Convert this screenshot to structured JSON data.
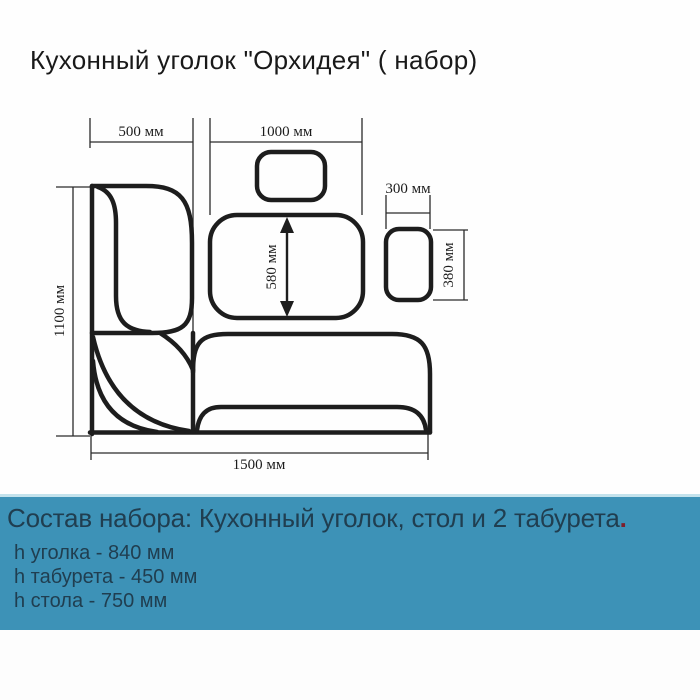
{
  "title": "Кухонный  уголок \"Орхидея\" ( набор)",
  "diagram": {
    "labels": {
      "corner_back_width": "500 мм",
      "bench_width": "1000 мм",
      "stool_width": "300 мм",
      "table_depth": "580 мм",
      "stool_depth": "380 мм",
      "corner_height": "1100 мм",
      "bench_length": "1500 мм"
    }
  },
  "banner": {
    "heading": "Состав набора: Кухонный уголок, стол и 2 табурета",
    "heading_period": ".",
    "specs": [
      "h уголка - 840 мм",
      "h табурета - 450 мм",
      "h стола - 750 мм"
    ],
    "colors": {
      "background": "#3d92b7",
      "top_line": "#c3e2ec",
      "text": "#203e50",
      "period_accent": "#7e1e2b"
    }
  },
  "drawing_colors": {
    "furniture_outline": "#1d1d1d",
    "dimension_lines": "#2b2b2b"
  }
}
